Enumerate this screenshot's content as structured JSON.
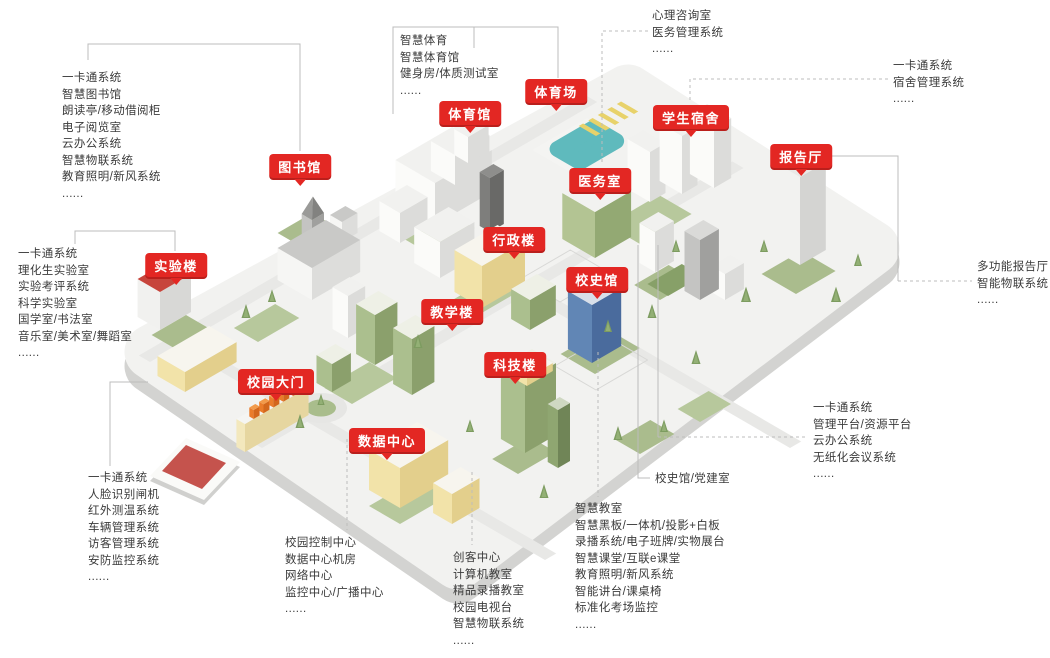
{
  "colors": {
    "badge_red": "#e32723",
    "text_gray": "#3b3b3b",
    "connector_gray": "#bcbcbc",
    "pool_teal": "#5fbabd",
    "building_yellow": "#f2e3a9",
    "building_green": "#abbf8e",
    "building_blue": "#6186b5"
  },
  "badges": {
    "library": {
      "label": "图书馆"
    },
    "lab": {
      "label": "实验楼"
    },
    "gate": {
      "label": "校园大门"
    },
    "datacenter": {
      "label": "数据中心"
    },
    "teaching": {
      "label": "教学楼"
    },
    "science": {
      "label": "科技楼"
    },
    "admin": {
      "label": "行政楼"
    },
    "history": {
      "label": "校史馆"
    },
    "clinic": {
      "label": "医务室"
    },
    "gym": {
      "label": "体育馆"
    },
    "stadium": {
      "label": "体育场"
    },
    "dorm": {
      "label": "学生宿舍"
    },
    "hall": {
      "label": "报告厅"
    }
  },
  "lists": {
    "library": {
      "items": [
        "一卡通系统",
        "智慧图书馆",
        "朗读亭/移动借阅柜",
        "电子阅览室",
        "云办公系统",
        "智慧物联系统",
        "教育照明/新风系统",
        "......"
      ]
    },
    "lab": {
      "items": [
        "一卡通系统",
        "理化生实验室",
        "实验考评系统",
        "科学实验室",
        "国学室/书法室",
        "音乐室/美术室/舞蹈室",
        "......"
      ]
    },
    "gate": {
      "items": [
        "一卡通系统",
        "人脸识别闸机",
        "红外测温系统",
        "车辆管理系统",
        "访客管理系统",
        "安防监控系统",
        "......"
      ]
    },
    "sports": {
      "items": [
        "智慧体育",
        "智慧体育馆",
        "健身房/体质测试室",
        "......"
      ]
    },
    "clinic": {
      "items": [
        "心理咨询室",
        "医务管理系统",
        "......"
      ]
    },
    "dorm": {
      "items": [
        "一卡通系统",
        "宿舍管理系统",
        "......"
      ]
    },
    "hall": {
      "items": [
        "多功能报告厅",
        "智能物联系统",
        "......"
      ]
    },
    "admin_platform": {
      "items": [
        "一卡通系统",
        "管理平台/资源平台",
        "云办公系统",
        "无纸化会议系统",
        "......"
      ]
    },
    "history_rooms": {
      "items": [
        "校史馆/党建室"
      ]
    },
    "classroom": {
      "items": [
        "智慧教室",
        "智慧黑板/一体机/投影+白板",
        "录播系统/电子班牌/实物展台",
        "智慧课堂/互联e课堂",
        "教育照明/新风系统",
        "智能讲台/课桌椅",
        "标准化考场监控",
        "......"
      ]
    },
    "maker": {
      "items": [
        "创客中心",
        "计算机教室",
        "精品录播教室",
        "校园电视台",
        "智慧物联系统",
        "......"
      ]
    },
    "control": {
      "items": [
        "校园控制中心",
        "数据中心机房",
        "网络中心",
        "监控中心/广播中心",
        "......"
      ]
    }
  }
}
